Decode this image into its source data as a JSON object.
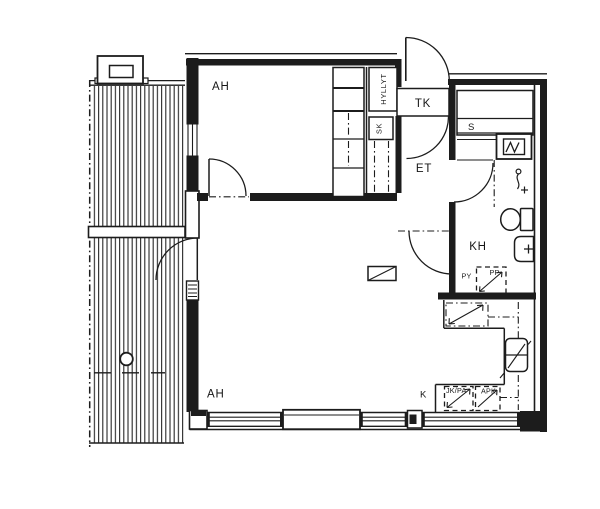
{
  "drawing": {
    "kind": "apartment-floor-plan",
    "background_color": "#ffffff",
    "line_color": "#1c1c1c"
  },
  "rooms": {
    "bedroom": {
      "label": "AH"
    },
    "living_room": {
      "label": "AH"
    },
    "hall": {
      "label": "ET"
    },
    "vestibule": {
      "label": "TK"
    },
    "sauna": {
      "label": "S"
    },
    "bathroom": {
      "label": "KH"
    },
    "kitchen": {
      "label": "K"
    }
  },
  "closets": {
    "shelves": {
      "label": "HYLLYT"
    },
    "cleaning": {
      "label": "SK"
    }
  },
  "appliances": {
    "washer": {
      "label": "PY"
    },
    "dryer": {
      "label": "PP"
    },
    "fridge_freezer": {
      "label": "JK/PA"
    },
    "dishwasher": {
      "label": "APK"
    }
  }
}
